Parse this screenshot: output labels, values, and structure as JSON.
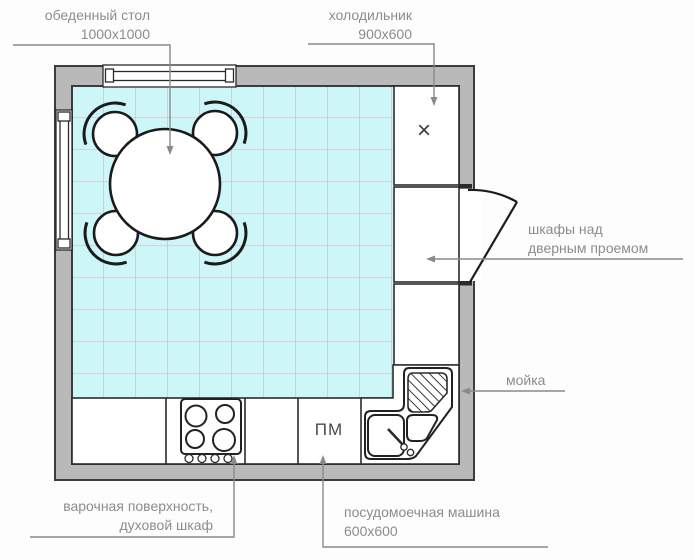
{
  "diagram": {
    "type": "kitchen floor plan",
    "marks": {
      "dishwasher": "ПМ",
      "fridge": "×"
    },
    "callouts": {
      "dining_table": {
        "name": "обеденный стол",
        "size": "1000x1000"
      },
      "fridge": {
        "name": "холодильник",
        "size": "900x600"
      },
      "door_cabinets": {
        "name_line1": "шкафы над",
        "name_line2": "дверным проемом"
      },
      "sink": {
        "name": "мойка"
      },
      "cooktop": {
        "name_line1": "варочная поверхность,",
        "name_line2": "духовой шкаф"
      },
      "dishwasher": {
        "name": "посудомоечная машина",
        "size": "600x600"
      }
    },
    "colors": {
      "wall": "#b9b9b9",
      "wall_outline": "#3c3c3c",
      "floor": "#cdf6f8",
      "grid_v": "#c2cdcd",
      "grid_h": "#dfc6c6",
      "label_text": "#8c8c8c",
      "leader": "#8a8a8a"
    }
  }
}
